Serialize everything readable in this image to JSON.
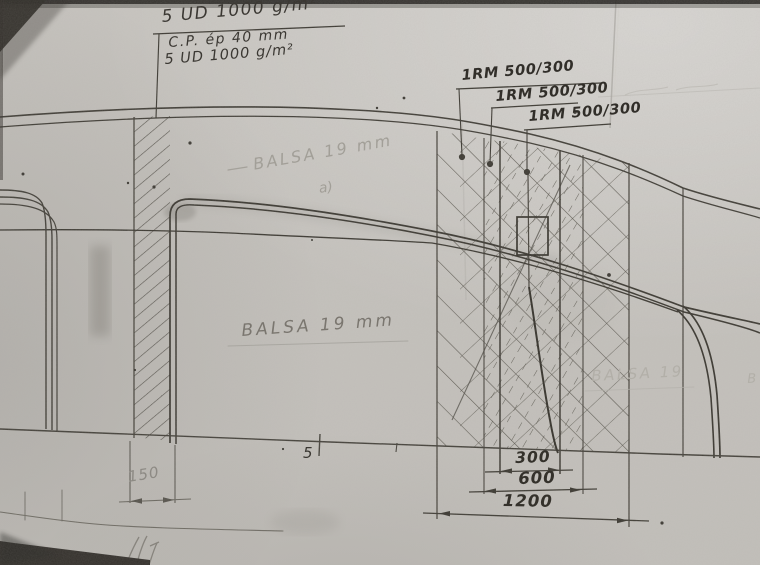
{
  "annotations": {
    "layup_note": {
      "line1": "5 UD 1000 g/m²",
      "line2": "C.P. ép 40 mm",
      "line3": "5 UD 1000 g/m²"
    },
    "rm_label_1": "1RM 500/300",
    "rm_label_2": "1RM 500/300",
    "rm_label_3": "1RM 500/300",
    "balsa_upper": "BALSA 19 mm",
    "balsa_upper_index": "a)",
    "balsa_center": "BALSA 19 mm",
    "balsa_right": "BALSA 19",
    "balsa_right_fragment": "B",
    "station_number": "5"
  },
  "dimensions": {
    "left_band": "150",
    "inner": "300",
    "middle": "600",
    "outer": "1200"
  },
  "colors": {
    "paper": "#c7c4bf",
    "pencil_dark": "#3b3833",
    "pencil_mid": "#5d5a53",
    "pencil_faint": "#999690"
  }
}
